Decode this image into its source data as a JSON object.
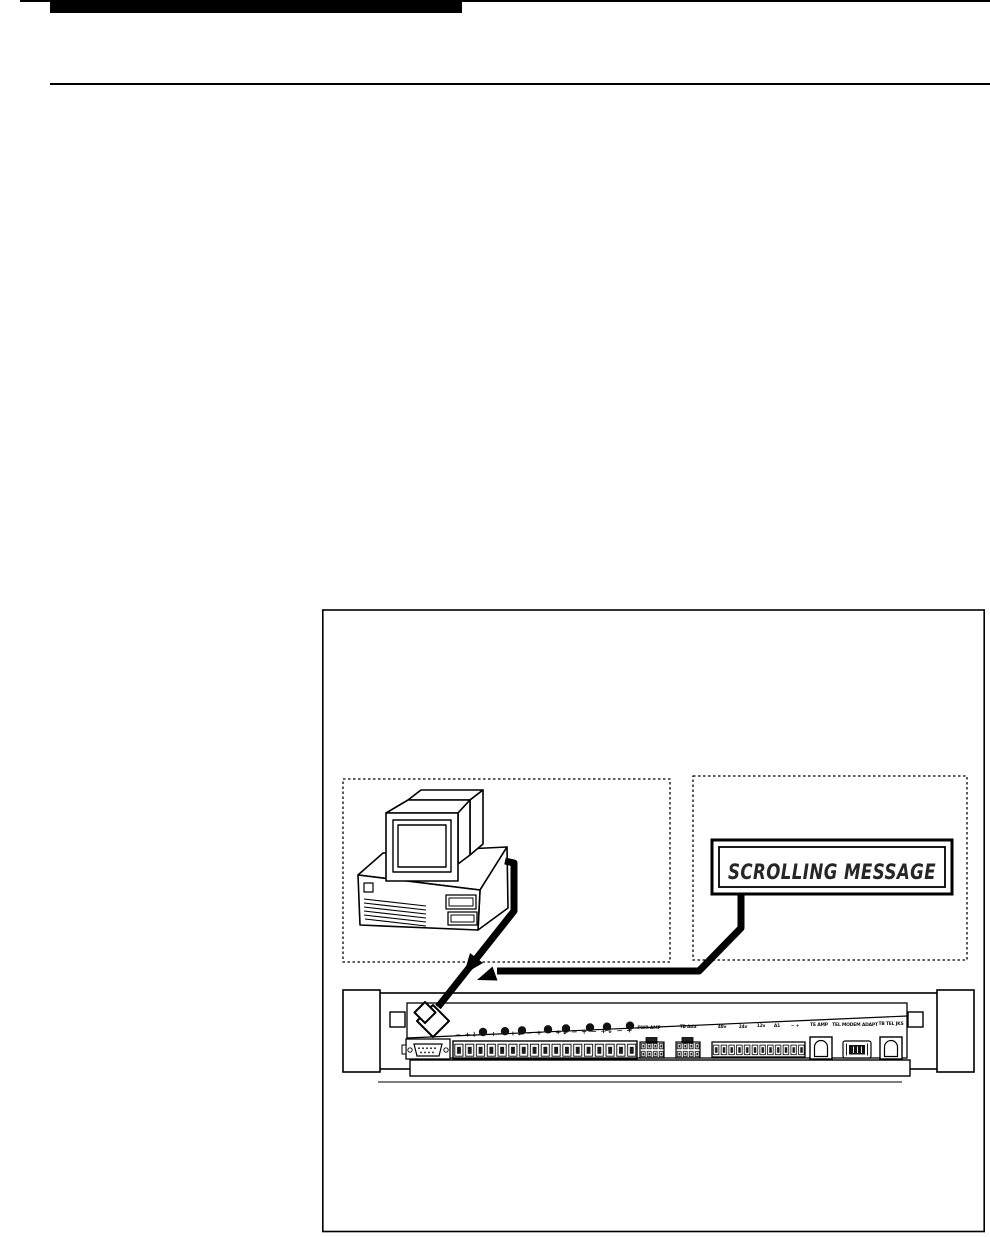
{
  "diagram": {
    "sign": {
      "text": "SCROLLING MESSAGE"
    },
    "device": {
      "polarity_row": "− +↓  − + − +↓  − + − +↓  − + − +↓  − +",
      "panel_labels": [
        "PWR AMP",
        "TB Ada",
        "48v",
        "24v",
        "12v",
        "A1",
        "− +",
        "TE AMP",
        "TEL MODEM ADAPT",
        "TB TEL JKS"
      ]
    },
    "colors": {
      "ink": "#000000",
      "paper": "#ffffff"
    }
  }
}
